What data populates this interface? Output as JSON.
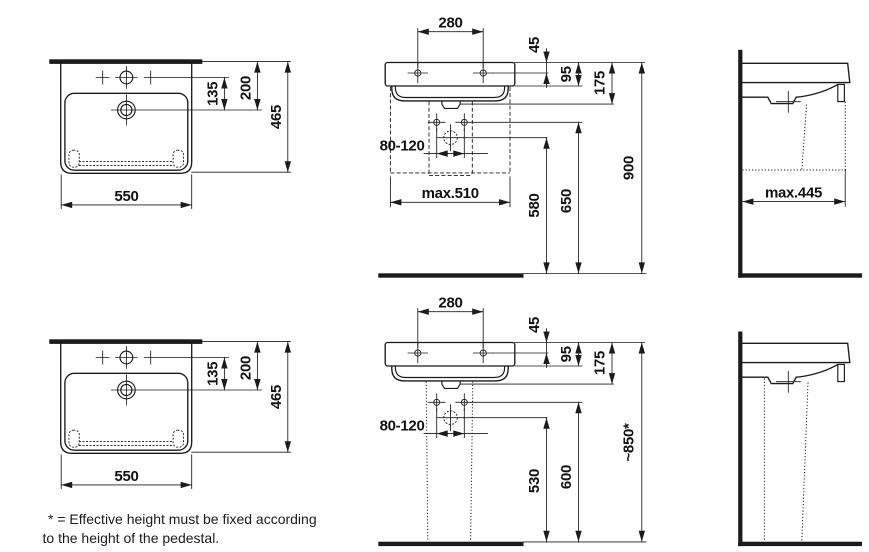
{
  "colors": {
    "ink": "#1b1b1b",
    "background": "#ffffff"
  },
  "views": {
    "plan_top": {
      "d135": "135",
      "d200": "200",
      "d465": "465",
      "d550": "550"
    },
    "plan_bottom": {
      "d135": "135",
      "d200": "200",
      "d465": "465",
      "d550": "550"
    },
    "front_wall_hung": {
      "d280": "280",
      "d45": "45",
      "d95": "95",
      "d175": "175",
      "d80_120": "80-120",
      "dmax510": "max.510",
      "d580": "580",
      "d650": "650",
      "d900": "900"
    },
    "front_pedestal": {
      "d280": "280",
      "d45": "45",
      "d95": "95",
      "d175": "175",
      "d80_120": "80-120",
      "d530": "530",
      "d600": "600",
      "d850": "~850*"
    },
    "side_wall_hung": {
      "dmax445": "max.445"
    }
  },
  "footnote": {
    "line1": "* = Effective height must be fixed according",
    "line2": "to the height of the pedestal."
  }
}
